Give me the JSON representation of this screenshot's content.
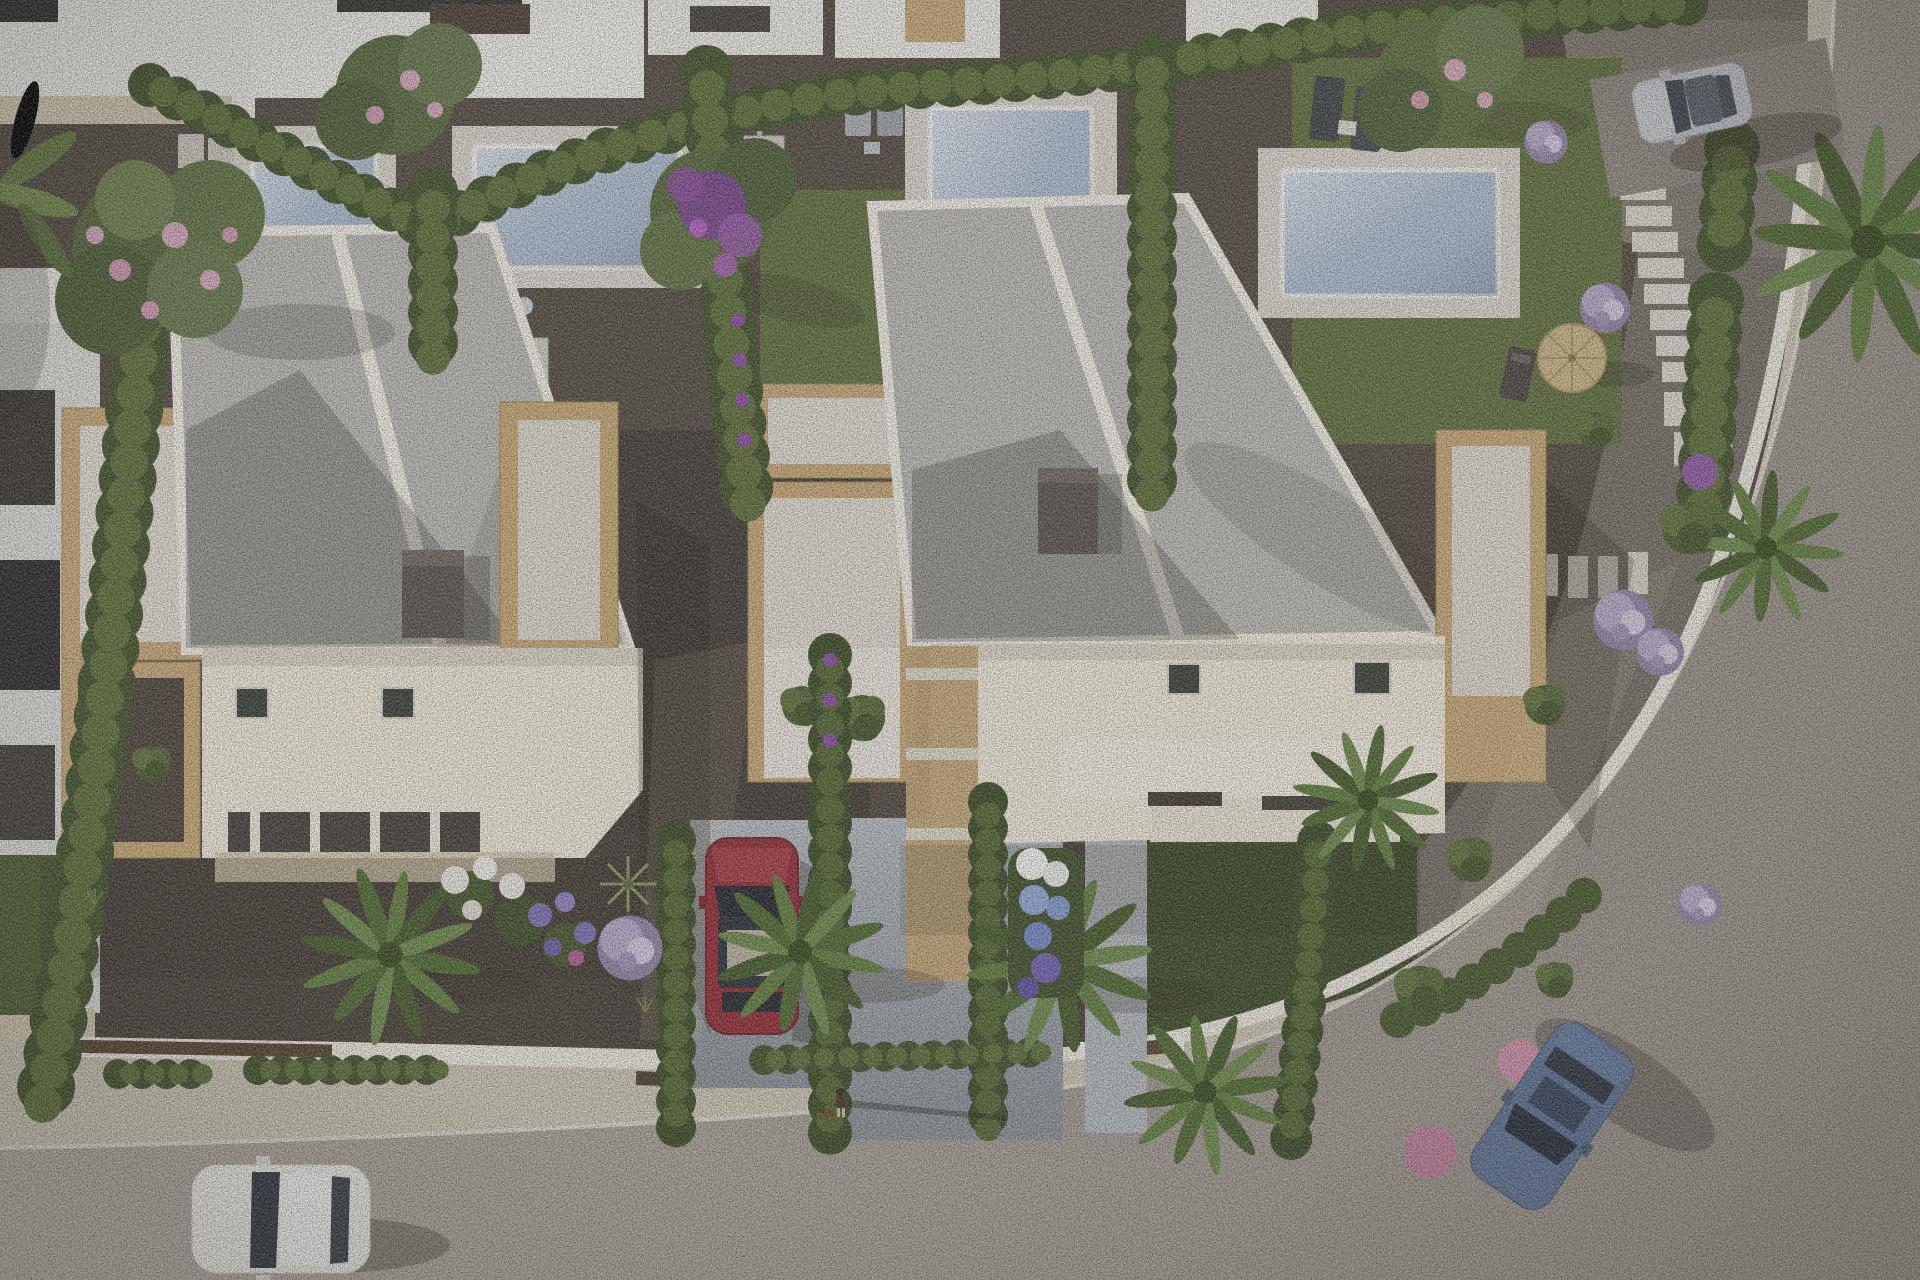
{
  "meta": {
    "title": "Aerial 3D architectural rendering of a residential development",
    "view": "top-down aerial, late-afternoon sun from the left casting long shadows to the right"
  },
  "scene": {
    "villas": [
      {
        "id": "villa-left",
        "features": "flat light-gray two-panel roof, white parapet, dark chimney, sandstone-clad terrace boxes, skylights, front porch"
      },
      {
        "id": "villa-right",
        "features": "flat light-gray two-panel roof, white parapet, dark chimney, sandstone-clad terrace boxes, skylights, entry canopy"
      }
    ],
    "pool_count": 4,
    "cars": [
      {
        "color_name": "white",
        "location": "street bottom-left, heading left"
      },
      {
        "color_name": "dark red",
        "location": "parked in central driveway between villas"
      },
      {
        "color_name": "blue-gray",
        "location": "street bottom-right, angled down the curve"
      },
      {
        "color_name": "silver",
        "location": "parked on gravel drive top-right"
      }
    ],
    "pedestrian": {
      "description": "tiny figure walking a small brown dog on the sidewalk, long shadow to the right"
    },
    "garden_items": [
      "sun loungers",
      "outdoor showers",
      "stepping-stone paths",
      "straw parasol with deck chair"
    ],
    "vegetation": [
      "clipped hedge rows",
      "cypress columns",
      "palm trees",
      "pink flowering trees",
      "purple flowering tree",
      "lilac ball shrubs",
      "white-to-purple hydrangea bed"
    ]
  },
  "colors": {
    "gravel_base": "#4f473d",
    "gravel_dark": "#3f3933",
    "gravel_mid": "#564d42",
    "gravel_light": "#716c62",
    "gravel_parking": "#7e786d",
    "lawn": "#5e6d3c",
    "lawn_dark": "#3c4a27",
    "hedge_dark": "#41502a",
    "hedge_light": "#5c6c38",
    "cypress": "#3b4a26",
    "stone": "#c4a474",
    "stone_floor": "#dcd7cd",
    "roof_gray": "#b7b5b1",
    "parapet_white": "#eee9e0",
    "wall_cream": "#ece5d6",
    "chimney": "#5a534c",
    "pool_deck": "#d6d2c9",
    "pool_water": "#a3b4c8",
    "sidewalk": "#c8c1b0",
    "road": "#a59d93",
    "curb_white": "#ddd8cc",
    "driveway": "#9aa1a8",
    "front_wall_white": "#e7e3d8",
    "gate_brown": "#55422f",
    "car_red": "#8e2a33",
    "car_white": "#e9e8e4",
    "car_blue": "#5d7090",
    "car_silver": "#babdc1",
    "flower_purple": "#8a4aa0",
    "flower_pink": "#d2a4b6",
    "flower_lilac": "#b3a6c4",
    "hydrangea_blue": "#8ea6d4",
    "umbrella_straw": "#c6b184"
  }
}
